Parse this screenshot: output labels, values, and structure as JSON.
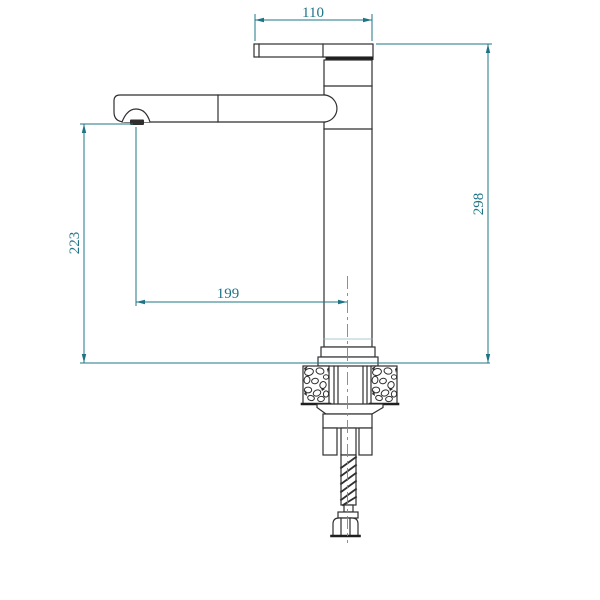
{
  "drawing": {
    "subject": "faucet-technical-drawing",
    "colors": {
      "background": "#ffffff",
      "outline": "#2f2f2f",
      "dimension": "#1e7486"
    },
    "dimensions": {
      "d110": {
        "label": "110",
        "orientation": "horizontal",
        "location": "top-handle-width"
      },
      "d298": {
        "label": "298",
        "orientation": "vertical",
        "location": "right-total-height"
      },
      "d223": {
        "label": "223",
        "orientation": "vertical",
        "location": "left-spout-height"
      },
      "d199": {
        "label": "199",
        "orientation": "horizontal",
        "location": "spout-reach-to-center"
      }
    }
  }
}
